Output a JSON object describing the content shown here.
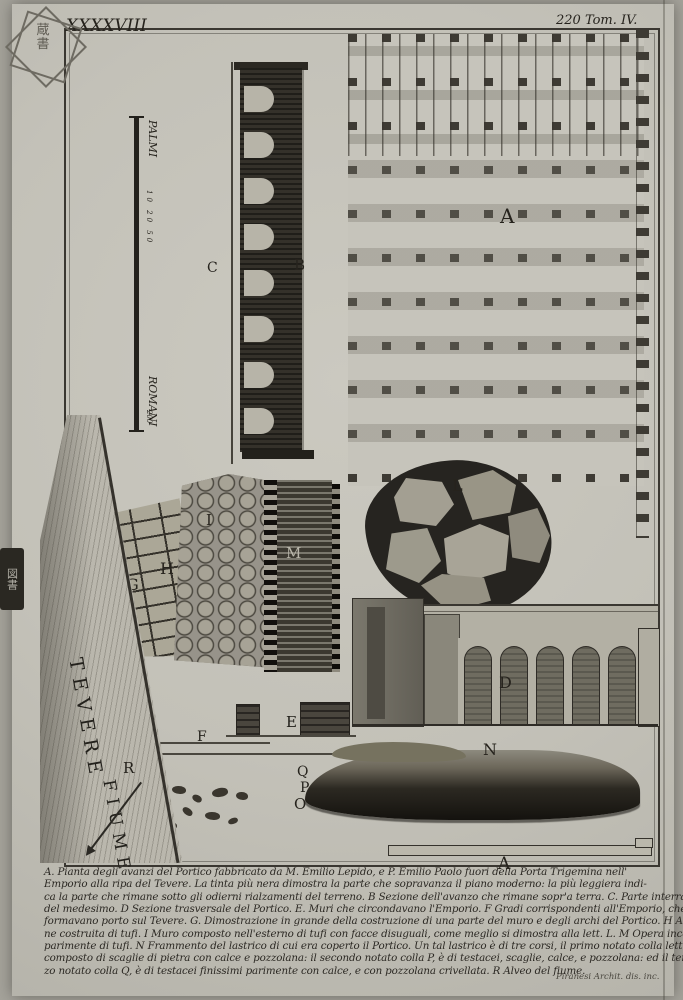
{
  "header": {
    "plate_number": "XXXXVIII",
    "tome": "220 Tom. IV."
  },
  "scalebar": {
    "unit_top": "PALMI",
    "unit_bottom": "ROMANI",
    "ticks_top": "10 20 50",
    "tick_bottom": "200"
  },
  "river": {
    "name_line1": "TEVERE",
    "name_line2": "FIUME"
  },
  "labels": {
    "plan_a": "A",
    "b": "B",
    "c": "C",
    "d": "D",
    "e": "E",
    "f": "F",
    "g": "G",
    "h": "H",
    "i": "I",
    "l": "L",
    "m": "M",
    "n": "N",
    "o": "O",
    "p": "P",
    "q": "Q",
    "r": "R",
    "bottom_a": "A"
  },
  "caption": {
    "lines": [
      "A. Pianta degli avanzi del Portico fabbricato da M. Emilio Lepido, e P. Emilio Paolo fuori della Porta Trigemina nell'",
      "Emporio alla ripa del Tevere. La tinta più nera dimostra la parte che sopravanza il piano moderno: la più leggiera indi-",
      "ca la parte che rimane sotto gli odierni rialzamenti del terreno. B Sezione dell'avanzo che rimane sopr'a terra. C. Parte interrata",
      "del medesimo. D Sezione trasversale del Portico. E. Muri che circondavano l'Emporio. F Gradi corrispondenti all'Emporio, che",
      "formavano porto sul Tevere. G. Dimostrazione in grande della costruzione di una parte del muro e degli archi del Portico. H Arcuazio-",
      "ne costruita di tufi. I Muro composto nell'esterno di tufi con facce disuguali, come meglio si dimostra alla lett. L. M Opera incerta, comp.",
      "parimente di tufi. N Frammento del lastrico di cui era coperto il Portico. Un tal lastrico è di tre corsi, il primo notato colla lett. O, è",
      "composto di scaglie di pietra con calce e pozzolana: il secondo notato colla P, è di testacei, scaglie, calce, e pozzolana: ed il ter-",
      "zo notato colla Q, è di testacei finissimi parimente con calce, e con pozzolana crivellata. R Alveo del fiume."
    ]
  },
  "signature": "Piranesi Archit. dis. inc.",
  "stamps": {
    "corner_glyphs": "蔵 書",
    "edge_glyphs": "図書"
  },
  "colors": {
    "paper": "#c6c4bb",
    "ink": "#2b2823",
    "mid_gray": "#8a8779"
  }
}
